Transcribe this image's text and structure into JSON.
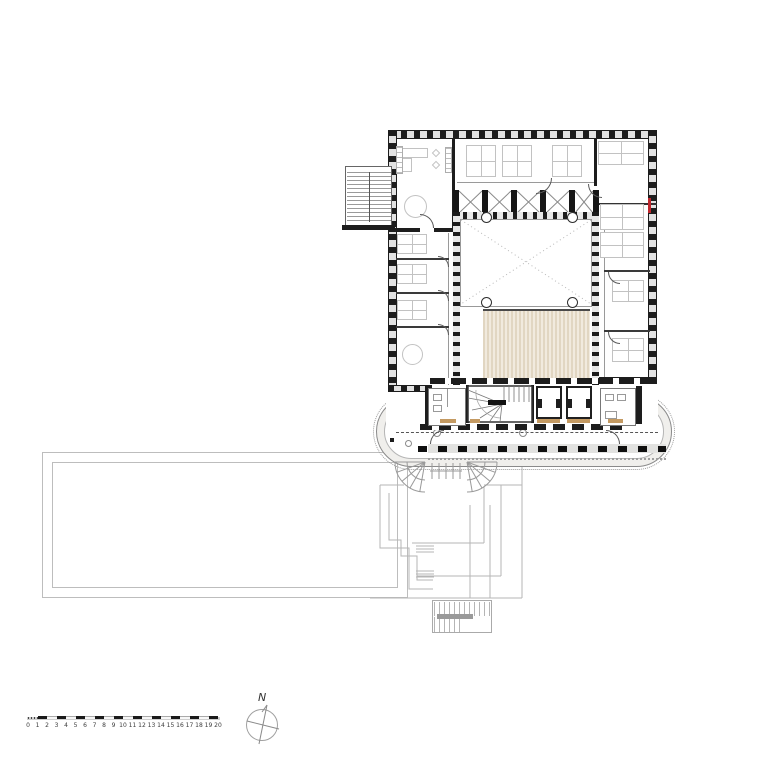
{
  "colors": {
    "paper": "#ffffff",
    "wall_dark": "#1d1d1d",
    "line_light": "#9a9a9a",
    "line_faint": "#bdbdbd",
    "furniture": "#c2c2c2",
    "gallery_fill": "#f0efec",
    "deck_fill": "#e6dcc8",
    "sill_tan": "#c49a62",
    "marker_red": "#c0272d"
  },
  "north": {
    "label": "N"
  },
  "icons": {
    "north_arrow": "compass-with-needle"
  },
  "scale_bar": {
    "labels": [
      "0",
      "1",
      "2",
      "3",
      "4",
      "5",
      "6",
      "7",
      "8",
      "9",
      "10",
      "11",
      "12",
      "13",
      "14",
      "15",
      "16",
      "17",
      "18",
      "19",
      "20"
    ],
    "unit_px": 9.5
  }
}
